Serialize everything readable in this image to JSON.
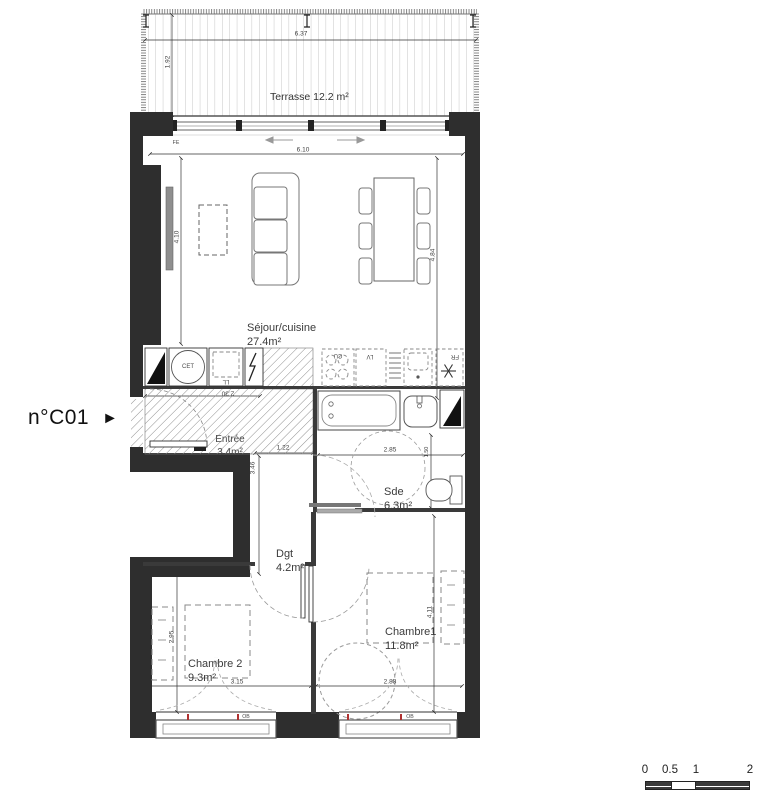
{
  "title": {
    "unit": "n°C01",
    "arrow": "►"
  },
  "rooms": {
    "terrasse": {
      "label": "Terrasse 12.2 m²"
    },
    "sejour": {
      "name": "Séjour/cuisine",
      "area": "27.4m²"
    },
    "entree": {
      "name": "Entrée",
      "area": "3.4m²"
    },
    "sde": {
      "name": "Sde",
      "area": "6.3m²"
    },
    "dgt": {
      "name": "Dgt",
      "area": "4.2m²"
    },
    "chambre2": {
      "name": "Chambre 2",
      "area": "9.3m²"
    },
    "chambre1": {
      "name": "Chambre1",
      "area": "11.8m²"
    }
  },
  "equipment": {
    "cet": "CET",
    "ll": "LL",
    "cu": "CU",
    "lv": "LV",
    "fr": "FR",
    "fe": "FE",
    "ob_left": "OB",
    "ob_right": "OB"
  },
  "dimensions": {
    "terrasse_w": "6.37",
    "terrasse_d": "1.92",
    "sejour_w": "6.10",
    "sejour_d_left": "4.10",
    "sejour_d_right": "4.84",
    "entree_w": "2.30",
    "dgt_w": "1.22",
    "dgt_d": "3.46",
    "sde_w": "2.85",
    "sde_d": "1.50",
    "chambre2_d": "2.95",
    "chambre1_d": "4.11",
    "chambre2_w": "3.15",
    "chambre1_w": "2.88"
  },
  "scale_bar": {
    "labels": [
      "0",
      "0.5",
      "1",
      "2"
    ]
  },
  "colors": {
    "wall": "#2e2e2e",
    "hatch": "#8a8a8a",
    "dashed_line": "#999999",
    "accent_red": "#b03030"
  }
}
